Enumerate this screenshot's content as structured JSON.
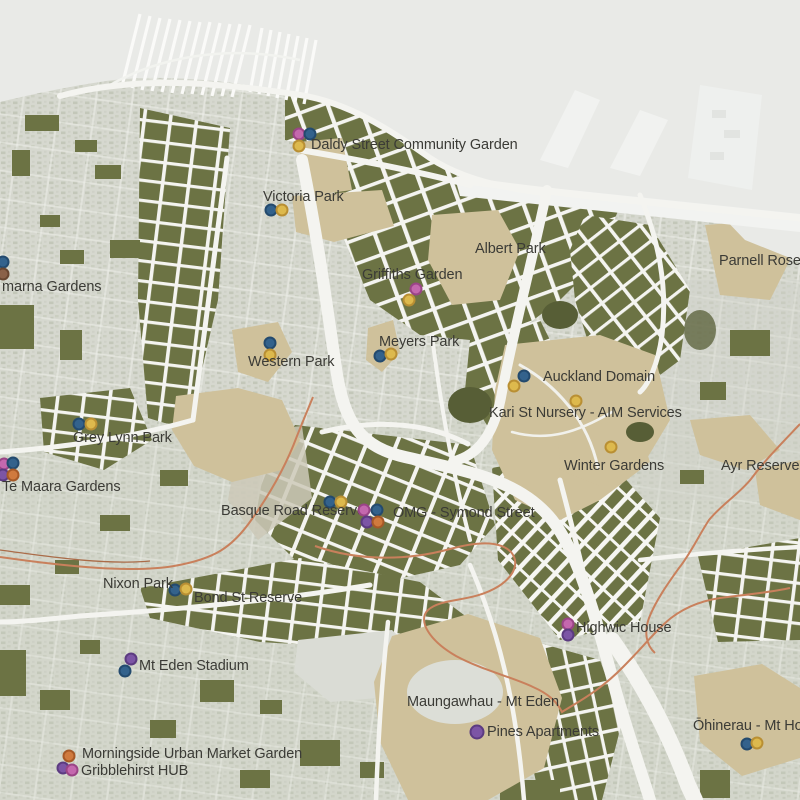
{
  "map": {
    "title": "Auckland inner-city community gardens map",
    "boundary_color": "#c9805c",
    "label_color": "#3b3b36",
    "palette": {
      "water": "#e9eae7",
      "land_texture": "#d6d8cf",
      "urban_blocks": "#6c7344",
      "parks_tan": "#cfc19b",
      "streets": "#f4f4f0"
    },
    "dot_colors": {
      "blue": {
        "fill": "#33628c",
        "ring": "#234a6e"
      },
      "yellow": {
        "fill": "#ddb94d",
        "ring": "#b98f33"
      },
      "pink": {
        "fill": "#c468ae",
        "ring": "#9a4486"
      },
      "purple": {
        "fill": "#7c55a5",
        "ring": "#5c3b81"
      },
      "orange": {
        "fill": "#d07a3e",
        "ring": "#a65927"
      },
      "brown": {
        "fill": "#8a6148",
        "ring": "#684630"
      }
    },
    "locations": [
      {
        "id": "daldy-street-community-garden",
        "label": "Daldy Street Community Garden",
        "tx": 311,
        "ty": 138,
        "dots": [
          {
            "c": "pink",
            "x": 299,
            "y": 134
          },
          {
            "c": "blue",
            "x": 310,
            "y": 134
          },
          {
            "c": "yellow",
            "x": 299,
            "y": 146
          }
        ]
      },
      {
        "id": "victoria-park",
        "label": "Victoria Park",
        "tx": 263,
        "ty": 190,
        "dots": [
          {
            "c": "blue",
            "x": 271,
            "y": 210
          },
          {
            "c": "yellow",
            "x": 282,
            "y": 210
          }
        ]
      },
      {
        "id": "albert-park",
        "label": "Albert Park",
        "tx": 475,
        "ty": 242,
        "dots": []
      },
      {
        "id": "griffiths-garden",
        "label": "Griffiths Garden",
        "tx": 362,
        "ty": 268,
        "dots": [
          {
            "c": "pink",
            "x": 416,
            "y": 289
          },
          {
            "c": "yellow",
            "x": 409,
            "y": 300
          }
        ]
      },
      {
        "id": "meyers-park",
        "label": "Meyers Park",
        "tx": 379,
        "ty": 335,
        "dots": [
          {
            "c": "blue",
            "x": 380,
            "y": 356
          },
          {
            "c": "yellow",
            "x": 391,
            "y": 354
          }
        ]
      },
      {
        "id": "western-park",
        "label": "Western Park",
        "tx": 248,
        "ty": 355,
        "dots": [
          {
            "c": "blue",
            "x": 270,
            "y": 343
          },
          {
            "c": "yellow",
            "x": 270,
            "y": 355
          }
        ]
      },
      {
        "id": "auckland-domain",
        "label": "Auckland Domain",
        "tx": 543,
        "ty": 370,
        "dots": [
          {
            "c": "blue",
            "x": 524,
            "y": 376
          },
          {
            "c": "yellow",
            "x": 514,
            "y": 386
          }
        ]
      },
      {
        "id": "kari-st-nursery-aim-services",
        "label": "Kari St Nursery - AIM Services",
        "tx": 489,
        "ty": 406,
        "dots": [
          {
            "c": "yellow",
            "x": 576,
            "y": 401
          }
        ]
      },
      {
        "id": "winter-gardens",
        "label": "Winter Gardens",
        "tx": 564,
        "ty": 459,
        "dots": [
          {
            "c": "yellow",
            "x": 611,
            "y": 447
          }
        ]
      },
      {
        "id": "ayr-reserve",
        "label": "Ayr Reserve",
        "tx": 721,
        "ty": 459,
        "dots": []
      },
      {
        "id": "parnell-rose-gardens",
        "label": "Parnell Rose Gardens",
        "tx": 719,
        "ty": 254,
        "dots": []
      },
      {
        "id": "kelmarna-gardens",
        "label": "marna Gardens",
        "tx": 2,
        "ty": 280,
        "dots": [
          {
            "c": "blue",
            "x": 3,
            "y": 262
          },
          {
            "c": "brown",
            "x": 3,
            "y": 274
          }
        ]
      },
      {
        "id": "grey-lynn-park",
        "label": "Grey Lynn Park",
        "tx": 73,
        "ty": 431,
        "dots": [
          {
            "c": "blue",
            "x": 79,
            "y": 424
          },
          {
            "c": "yellow",
            "x": 91,
            "y": 424
          }
        ]
      },
      {
        "id": "te-maara-gardens",
        "label": "Te Maara Gardens",
        "tx": 2,
        "ty": 480,
        "dots": [
          {
            "c": "pink",
            "x": 4,
            "y": 464
          },
          {
            "c": "blue",
            "x": 13,
            "y": 463
          },
          {
            "c": "purple",
            "x": 3,
            "y": 475
          },
          {
            "c": "orange",
            "x": 13,
            "y": 475
          }
        ]
      },
      {
        "id": "basque-road-reserve",
        "label": "Basque Road Reserve",
        "tx": 221,
        "ty": 504,
        "dots": [
          {
            "c": "blue",
            "x": 330,
            "y": 502
          },
          {
            "c": "yellow",
            "x": 341,
            "y": 502
          }
        ]
      },
      {
        "id": "omg-symond-street",
        "label": "OMG - Symond Street",
        "tx": 393,
        "ty": 506,
        "dots": [
          {
            "c": "pink",
            "x": 364,
            "y": 510
          },
          {
            "c": "blue",
            "x": 377,
            "y": 510
          },
          {
            "c": "purple",
            "x": 367,
            "y": 522
          },
          {
            "c": "orange",
            "x": 378,
            "y": 522
          }
        ]
      },
      {
        "id": "nixon-park",
        "label": "Nixon Park",
        "tx": 103,
        "ty": 577,
        "dots": [
          {
            "c": "blue",
            "x": 175,
            "y": 590
          },
          {
            "c": "yellow",
            "x": 186,
            "y": 589
          }
        ]
      },
      {
        "id": "bond-st-reserve",
        "label": "Bond St Reserve",
        "tx": 194,
        "ty": 591,
        "dots": []
      },
      {
        "id": "mt-eden-stadium",
        "label": "Mt Eden Stadium",
        "tx": 139,
        "ty": 659,
        "dots": [
          {
            "c": "purple",
            "x": 131,
            "y": 659
          },
          {
            "c": "blue",
            "x": 125,
            "y": 671
          }
        ]
      },
      {
        "id": "morningside-urban-market-garden",
        "label": "Morningside Urban Market Garden",
        "tx": 82,
        "ty": 747,
        "dots": [
          {
            "c": "orange",
            "x": 69,
            "y": 756
          }
        ]
      },
      {
        "id": "gribblehirst-hub",
        "label": "Gribblehirst HUB",
        "tx": 81,
        "ty": 764,
        "dots": [
          {
            "c": "purple",
            "x": 63,
            "y": 768
          },
          {
            "c": "pink",
            "x": 72,
            "y": 770
          }
        ]
      },
      {
        "id": "highwic-house",
        "label": "Highwic House",
        "tx": 576,
        "ty": 621,
        "dots": [
          {
            "c": "pink",
            "x": 568,
            "y": 624
          },
          {
            "c": "purple",
            "x": 568,
            "y": 635
          }
        ]
      },
      {
        "id": "maungawhau-mt-eden",
        "label": "Maungawhau - Mt Eden",
        "tx": 407,
        "ty": 695,
        "dots": []
      },
      {
        "id": "pines-apartments",
        "label": "Pines Apartments",
        "tx": 487,
        "ty": 725,
        "dots": [
          {
            "c": "purple",
            "x": 477,
            "y": 732,
            "big": true
          }
        ]
      },
      {
        "id": "ohinerau-mt-hobson",
        "label": "Ōhinerau - Mt Hobson",
        "tx": 693,
        "ty": 719,
        "dots": [
          {
            "c": "blue",
            "x": 747,
            "y": 744
          },
          {
            "c": "yellow",
            "x": 757,
            "y": 743
          }
        ]
      }
    ]
  }
}
